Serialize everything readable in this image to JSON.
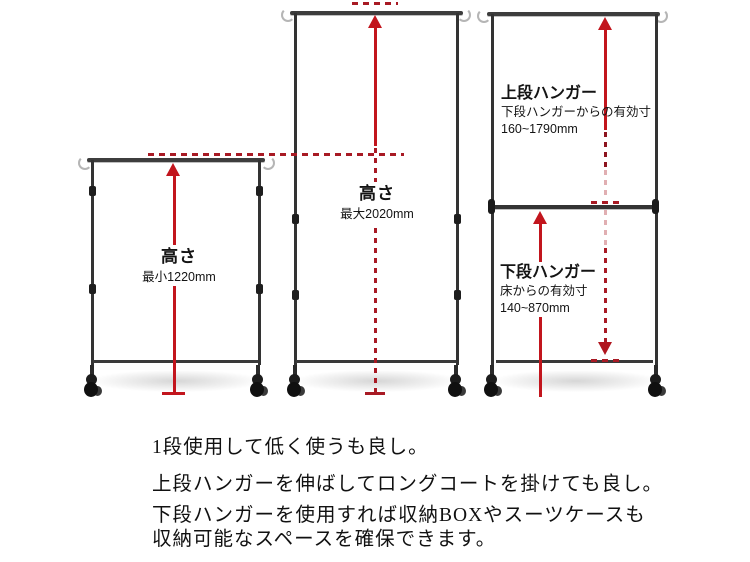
{
  "annotations": {
    "min_height": {
      "label": "高さ",
      "value": "最小1220mm"
    },
    "max_height": {
      "label": "高さ",
      "value": "最大2020mm"
    },
    "upper_hanger": {
      "label": "上段ハンガー",
      "desc": "下段ハンガーからの有効寸",
      "range": "160~1790mm"
    },
    "lower_hanger": {
      "label": "下段ハンガー",
      "desc": "床からの有効寸",
      "range": "140~870mm"
    }
  },
  "description": {
    "lines": [
      "1段使用して低く使うも良し。",
      "上段ハンガーを伸ばしてロングコートを掛けても良し。",
      "下段ハンガーを使用すれば収納BOXやスーツケースも",
      "収納可能なスペースを確保できます。"
    ]
  },
  "colors": {
    "arrow_solid": "#c2151d",
    "arrow_dashed": "#a81a24",
    "frame": "#333333",
    "text": "#141414"
  }
}
